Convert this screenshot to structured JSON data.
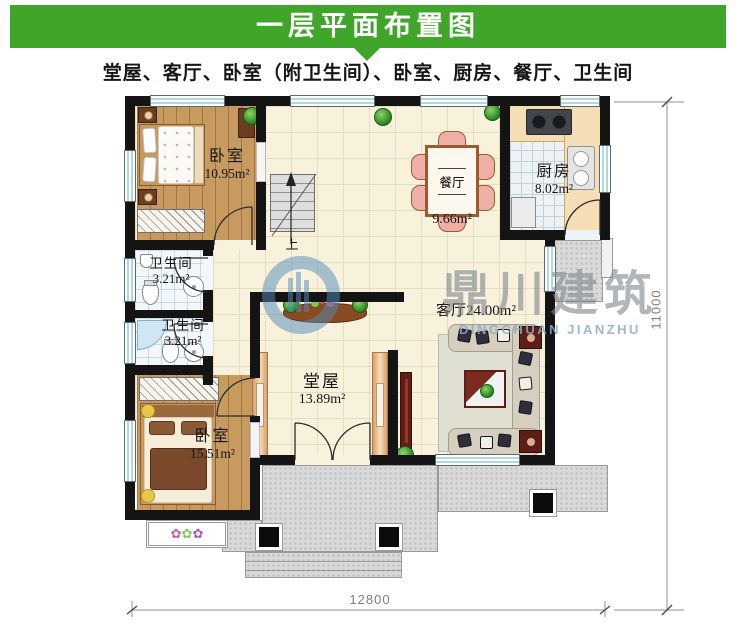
{
  "title": "一层平面布置图",
  "subtitle": "堂屋、客厅、卧室（附卫生间）、卧室、厨房、餐厅、卫生间",
  "rooms": {
    "bedroom1": {
      "name": "卧室",
      "area": "10.95m²"
    },
    "bath1": {
      "name": "卫生间",
      "area": "3.21m²"
    },
    "bath2": {
      "name": "卫生间",
      "area": "3.21m²"
    },
    "bedroom2": {
      "name": "卧室",
      "area": "15.51m²"
    },
    "hall": {
      "name": "堂屋",
      "area": "13.89m²"
    },
    "living": {
      "name": "客厅",
      "area": "24.00m²"
    },
    "dining": {
      "name": "餐厅",
      "area": "9.66m²"
    },
    "kitchen": {
      "name": "厨房",
      "area": "8.02m²"
    }
  },
  "stairs": {
    "up": "上"
  },
  "dims": {
    "width": "12800",
    "height": "11000"
  },
  "watermark": {
    "cn": "鼎川建筑",
    "en": "DINGCHUAN JIANZHU"
  },
  "colors": {
    "header_green": "#3fa62a",
    "wall": "#141414",
    "wood": "#c79a60",
    "floor_cream": "#f8f1dc",
    "porch_gray": "#d9d9d9",
    "accent_red": "#5e1d16",
    "window_blue": "#aed8e4",
    "watermark_blue": "#528cba"
  }
}
